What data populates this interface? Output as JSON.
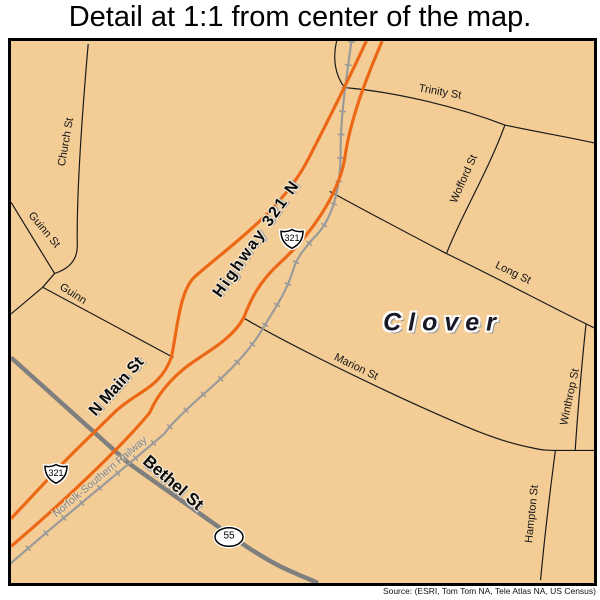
{
  "title": "Detail at 1:1 from center of the map.",
  "map": {
    "town_label": "Clover",
    "streets": {
      "church": "Church St",
      "guinn_st": "Guinn St",
      "guinn": "Guinn",
      "trinity": "Trinity St",
      "wofford": "Wofford St",
      "long": "Long St",
      "marion": "Marion St",
      "winthrop": "Winthrop St",
      "hampton": "Hampton St",
      "n_main": "N Main St",
      "highway_321": "Highway 321 N",
      "bethel": "Bethel St"
    },
    "railway_label": "Norfolk-Southern Railway",
    "shields": {
      "us_321": "321",
      "sc_55": "55"
    },
    "colors": {
      "background": "#F4CD96",
      "highway": "#EC6716",
      "railway": "#9A9A9A",
      "minor_road": "#1A1A1A",
      "major_road": "#7F7F7F"
    }
  },
  "footer": {
    "source": "Source: (ESRI, Tom Tom NA, Tele Atlas NA, US Census)"
  }
}
